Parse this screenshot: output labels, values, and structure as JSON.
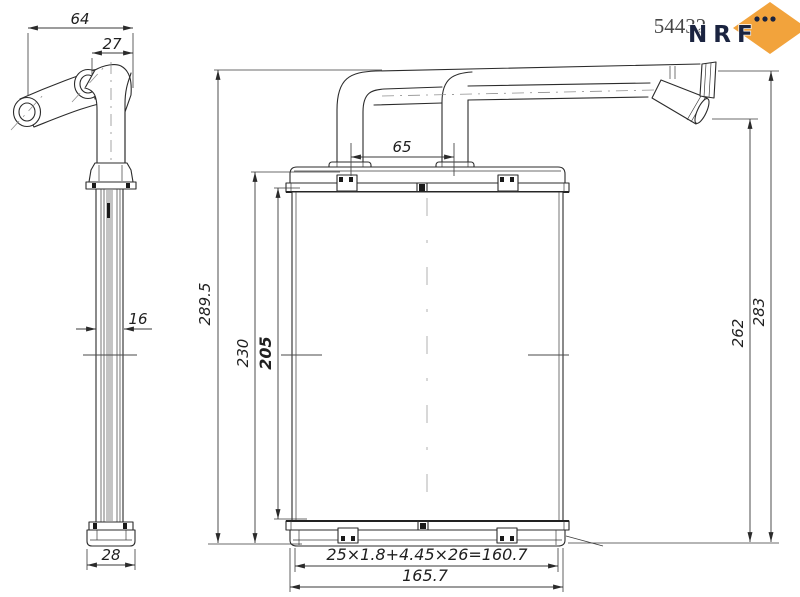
{
  "meta": {
    "part_number": "54432"
  },
  "brand": {
    "name": "NRF",
    "diamond_color": "#F2A33C",
    "letter_color": "#1B2440"
  },
  "dims": {
    "pipe_span": "64",
    "pipe_offset": "27",
    "port_spacing": "65",
    "overall_height": "289.5",
    "tank_to_tank_height": "230",
    "core_height": "205",
    "connector_height": "262",
    "pipe_top_height": "283",
    "core_depth": "16",
    "tank_depth": "28",
    "tube_formula": "25×1.8+4.45×26=160.7",
    "core_width": "165.7"
  }
}
